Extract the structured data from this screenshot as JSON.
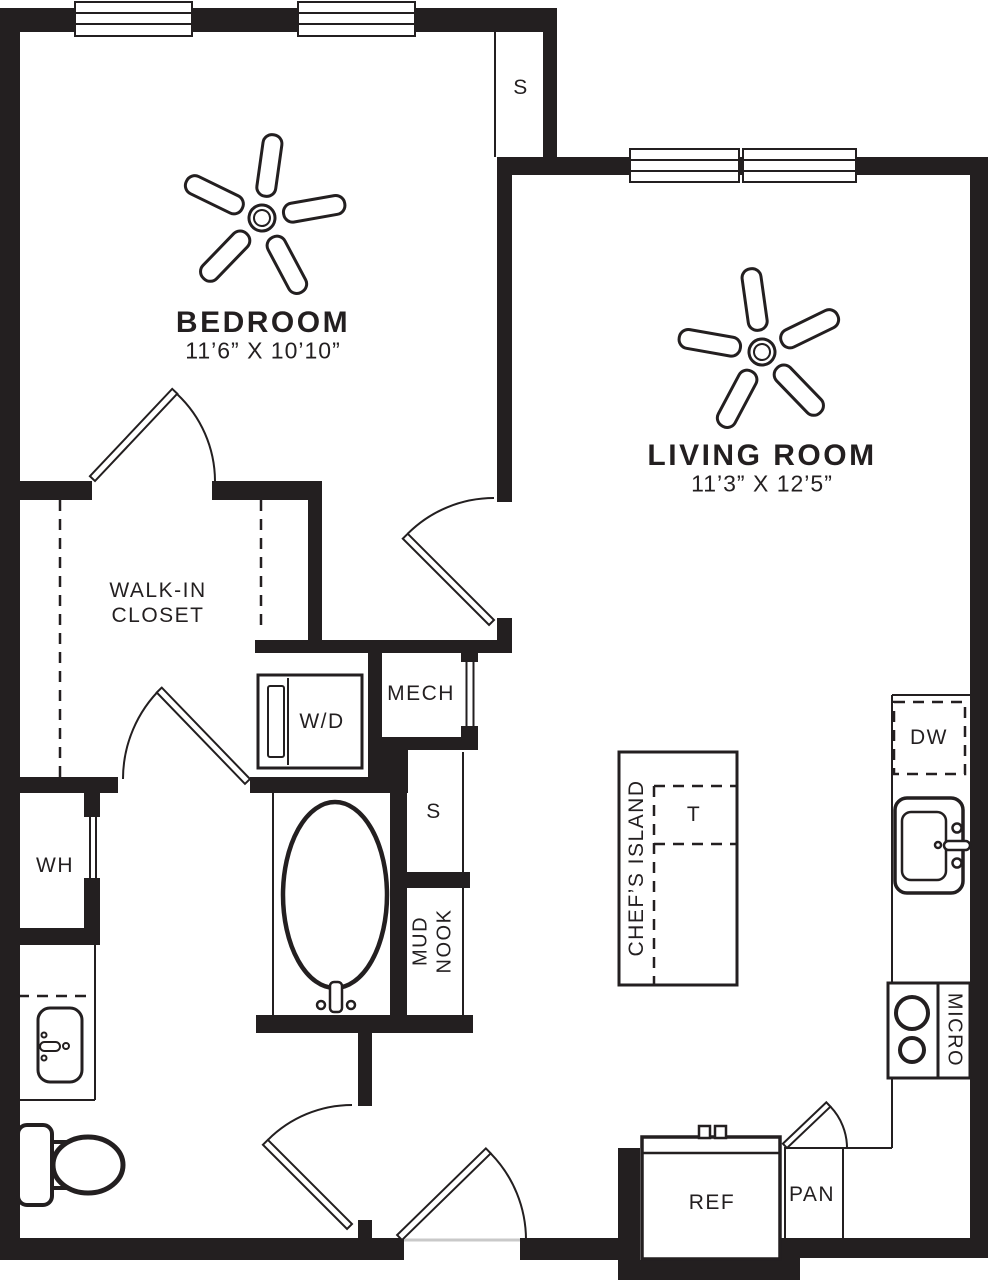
{
  "colors": {
    "wall": "#231f20",
    "background": "#ffffff"
  },
  "rooms": {
    "bedroom": {
      "name": "BEDROOM",
      "dims": "11’6” X 10’10”"
    },
    "living_room": {
      "name": "LIVING ROOM",
      "dims": "11’3” X 12’5”"
    },
    "walk_in_closet": {
      "line1": "WALK-IN",
      "line2": "CLOSET"
    }
  },
  "labels": {
    "storage_top": "S",
    "storage_mid": "S",
    "water_heater": "WH",
    "washer_dryer": "W/D",
    "mechanical": "MECH",
    "mud_nook_line1": "MUD",
    "mud_nook_line2": "NOOK",
    "chefs_island": "CHEF’S ISLAND",
    "island_t": "T",
    "dishwasher": "DW",
    "microwave": "MICRO",
    "refrigerator": "REF",
    "pantry": "PAN"
  },
  "icons": [
    "ceiling-fan-icon",
    "window-icon",
    "door-swing-icon",
    "bathtub-icon",
    "toilet-icon",
    "vanity-sink-icon",
    "kitchen-sink-icon",
    "cooktop-icon",
    "washer-dryer-icon",
    "refrigerator-icon",
    "dishwasher-icon",
    "kitchen-island-icon"
  ]
}
